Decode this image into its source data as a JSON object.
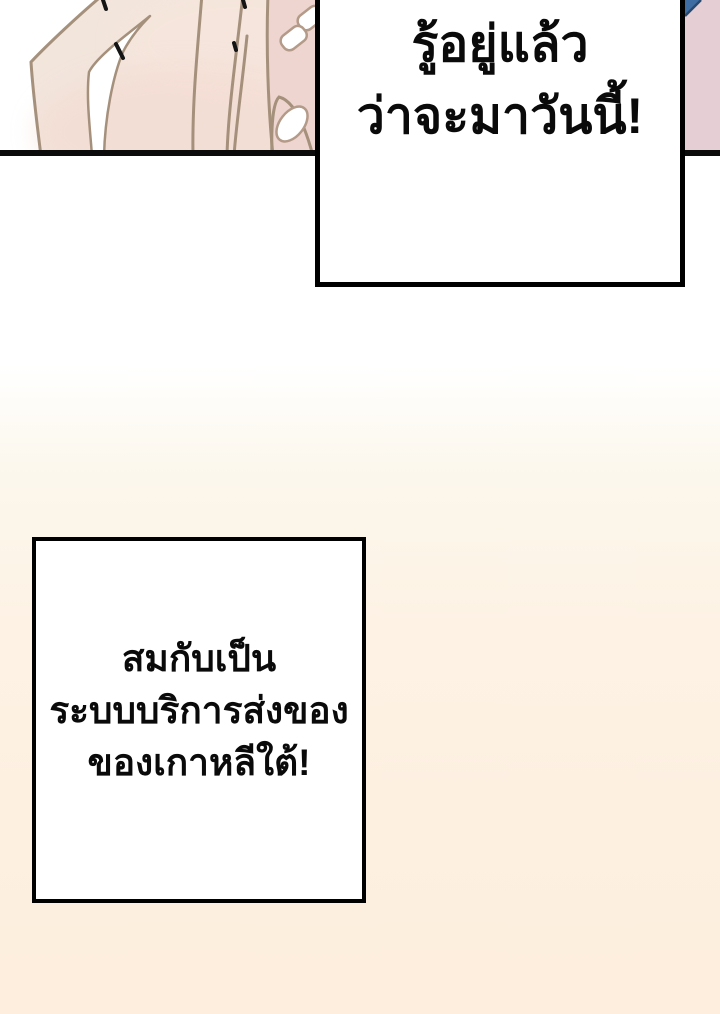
{
  "colors": {
    "background_top": "#ffffff",
    "background_bottom": "#fdeedd",
    "panel_border": "#0b0b0b",
    "bubble_background": "#ffffff",
    "bubble_border": "#000000",
    "text": "#0a0a0a",
    "skin": "#f2e5dc",
    "skin_outline": "#a5907c",
    "skin_shading_pink": "#f4d8cf",
    "fingertip_pink": "#eed5cf",
    "nail": "#ffffff",
    "nail_outline": "#b49a88",
    "corner_fabric_pink": "#e5ced4",
    "corner_fabric_blue": "#3e6da4"
  },
  "bubbles": {
    "top": {
      "lines": [
        "รู้อยู่แล้ว",
        "ว่าจะมาวันนี้!"
      ]
    },
    "bottom": {
      "lines": [
        "สมกับเป็น",
        "ระบบบริการส่งของ",
        "ของเกาหลีใต้!"
      ]
    }
  }
}
